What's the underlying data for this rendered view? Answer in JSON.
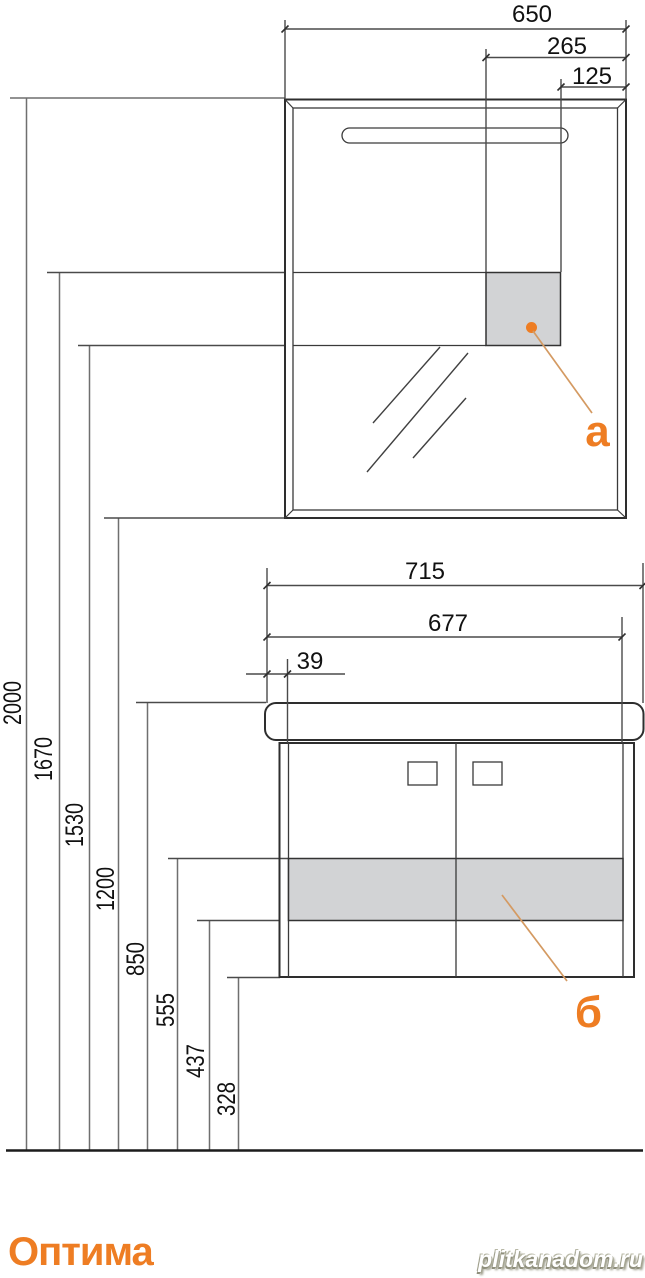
{
  "product": {
    "name": "Оптима"
  },
  "watermark": {
    "text": "plitkanadom.ru"
  },
  "mirror_cabinet": {
    "dim_width_total": "650",
    "dim_box_offset": "265",
    "dim_box_width": "125",
    "callout_label": "а"
  },
  "vanity": {
    "dim_countertop_width": "715",
    "dim_cabinet_width": "677",
    "dim_side_offset": "39",
    "callout_label": "б"
  },
  "heights": {
    "h2000": "2000",
    "h1670": "1670",
    "h1530": "1530",
    "h1200": "1200",
    "h850": "850",
    "h555": "555",
    "h437": "437",
    "h328": "328"
  },
  "colors": {
    "accent_orange": "#ee7d23",
    "leader_tan": "#d49a62",
    "panel_gray": "#d2d3d5"
  }
}
